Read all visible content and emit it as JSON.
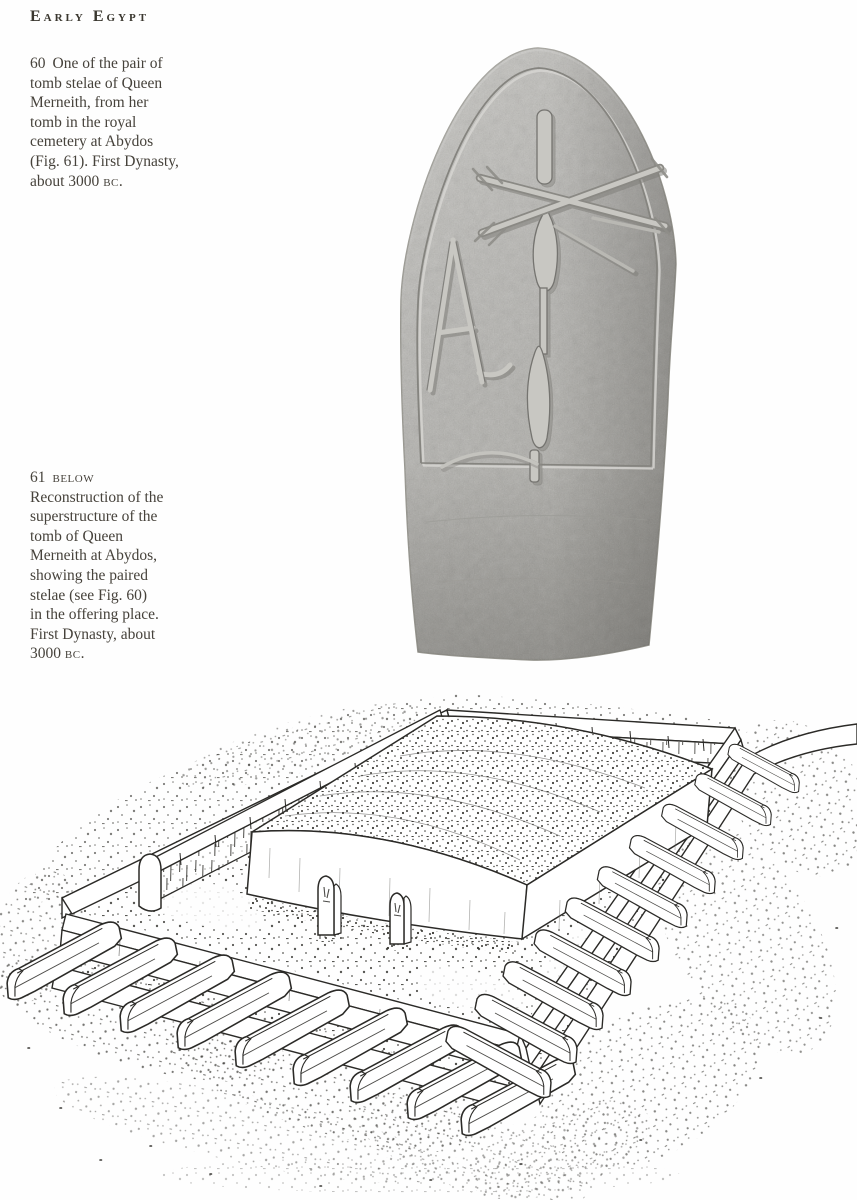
{
  "page": {
    "header": {
      "title": "Early Egypt"
    },
    "paper_color": "#fefefe",
    "text_color": "#46423b"
  },
  "captions": {
    "fig60": {
      "number": "60",
      "lines": [
        "One of the pair of",
        "tomb stelae of Queen",
        "Merneith, from her",
        "tomb in the royal",
        "cemetery at Abydos",
        "(Fig. 61). First Dynasty,"
      ],
      "last_line": {
        "pre": "about 3000 ",
        "era": "bc",
        "post": "."
      }
    },
    "fig61": {
      "number": "61",
      "position_label": "below",
      "lines": [
        "Reconstruction of the",
        "superstructure of the",
        "tomb of Queen",
        "Merneith at Abydos,",
        "showing the paired",
        "stelae (see Fig. 60)",
        "in the offering place.",
        "First Dynasty, about"
      ],
      "last_line": {
        "pre": "3000 ",
        "era": "bc",
        "post": "."
      }
    }
  },
  "figures": {
    "stela_photo": {
      "subject": "round-topped tomb stela of Queen Merneith with Neith emblem and hoe hieroglyphs"
    },
    "reconstruction_drawing": {
      "subject": "isometric reconstruction of tomb superstructure with enclosure wall, vaulted mound, paired stelae and rows of subsidiary graves"
    }
  },
  "colors": {
    "stone_gray": "#b6b5b1",
    "ink": "#2b2a27",
    "incised_line": "#85847f"
  }
}
